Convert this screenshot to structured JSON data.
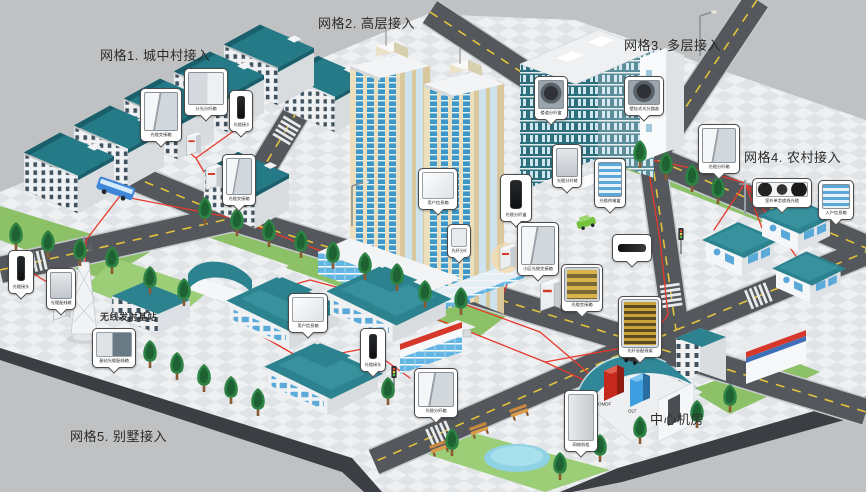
{
  "labels": {
    "grid1": "网格1. 城中村接入",
    "grid2": "网格2. 高层接入",
    "grid3": "网格3. 多层接入",
    "grid4": "网格4. 农村接入",
    "grid5": "网格5. 别墅接入",
    "base_station": "无线发射基站",
    "central_office": "中心机房",
    "omdf": "OMDF",
    "olt": "OLT"
  },
  "callouts": [
    {
      "label": "光缆交接箱"
    },
    {
      "label": "分光分纤箱"
    },
    {
      "label": "光缆接头盒"
    },
    {
      "label": "光缆交接箱"
    },
    {
      "label": "用户信息箱"
    },
    {
      "label": "光纤分纤盒"
    },
    {
      "label": "光缆分纤盒"
    },
    {
      "label": "小区光缆交接箱"
    },
    {
      "label": "楼道分纤盒"
    },
    {
      "label": "壁挂式光分路器"
    },
    {
      "label": "光缆分纤箱"
    },
    {
      "label": "光缆终端盒"
    },
    {
      "label": "光缆分纤箱"
    },
    {
      "label": "室外单芯皮线光缆"
    },
    {
      "label": "入户信息箱"
    },
    {
      "label": "用户信息箱"
    },
    {
      "label": "光缆接头盒"
    },
    {
      "label": "光缆分纤箱"
    },
    {
      "label": "基站光缆配线箱"
    },
    {
      "label": "光缆配线箱"
    },
    {
      "label": "光缆接头盒"
    },
    {
      "label": "光纤总配线架"
    },
    {
      "label": "光缆交接箱"
    },
    {
      "label": "光缆接头盒"
    },
    {
      "label": "网络机柜"
    }
  ],
  "colors": {
    "background": "#bfc1c3",
    "cable": "#e8392b",
    "road": "#54575c",
    "roof_teal": "#2c828f",
    "grass": "#8cc168",
    "highrise_cream": "#ecdfbd",
    "omdf_red": "#c5281c",
    "olt_blue": "#3e9fe0"
  }
}
